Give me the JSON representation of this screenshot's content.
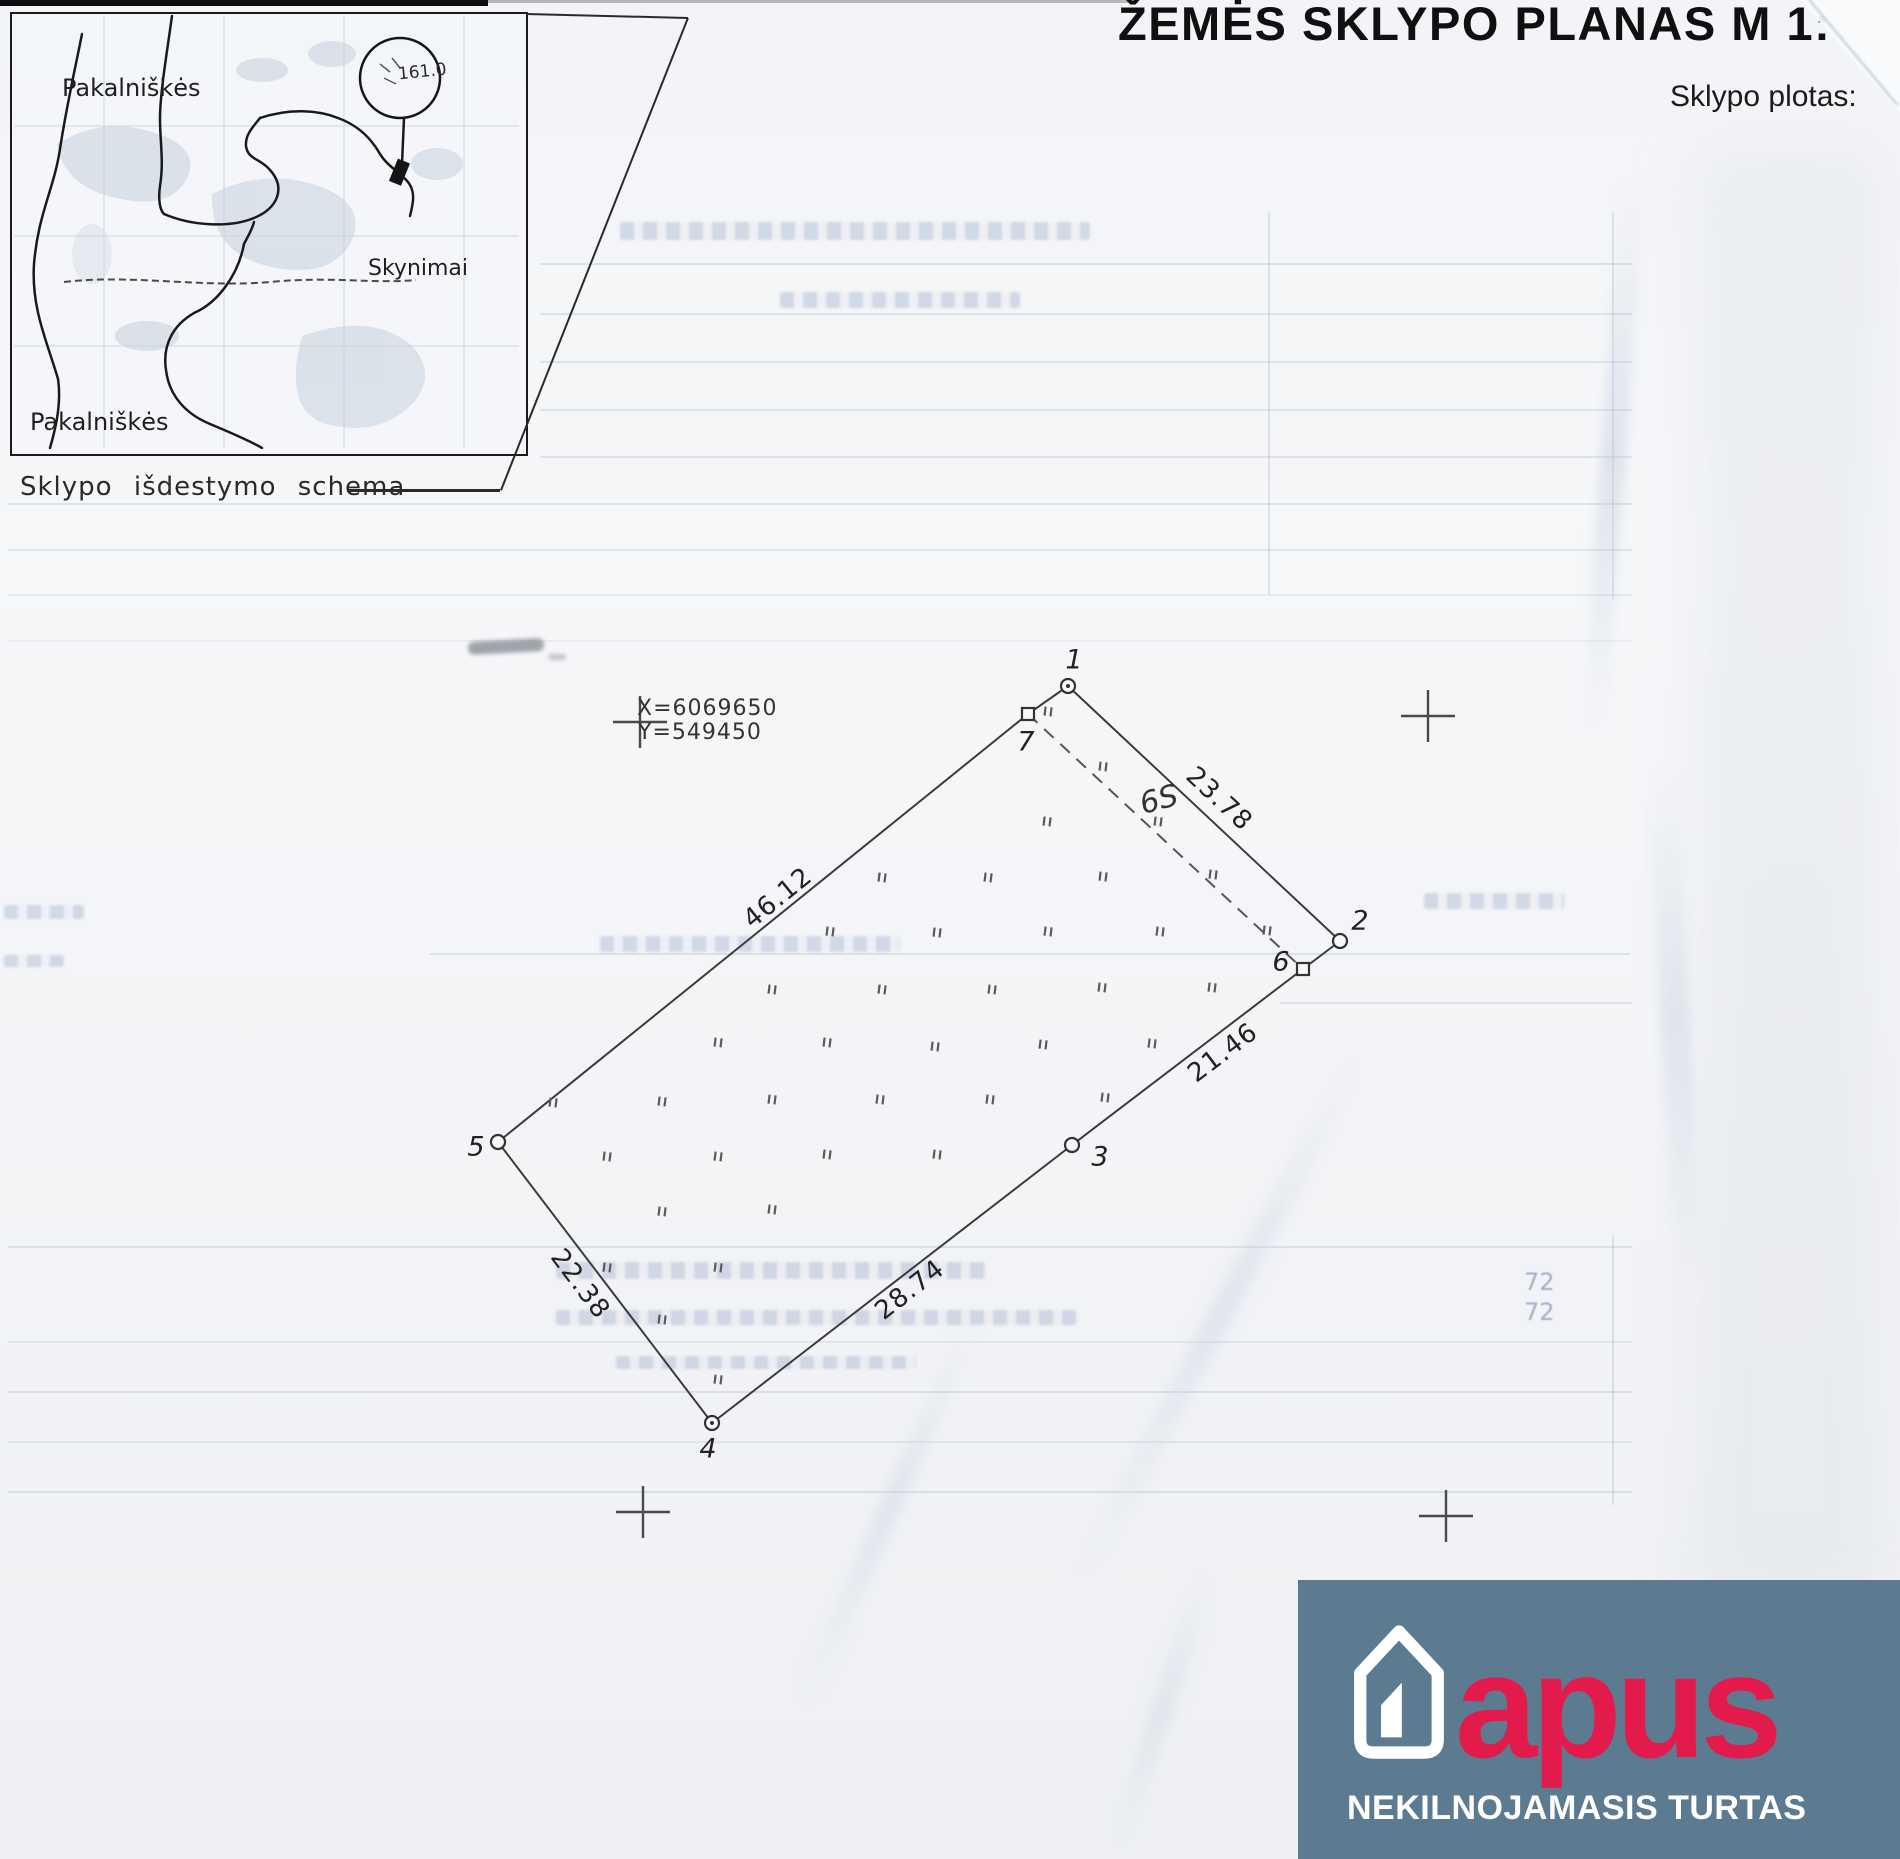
{
  "document": {
    "title": "ŽEMĖS SKLYPO PLANAS M 1:",
    "area_label": "Sklypo plotas:"
  },
  "inset_map": {
    "caption": "Sklypo išdestymo schema",
    "label_top": "Pakalniškės",
    "label_right": "Skynimai",
    "label_bottom": "Pakalniškės",
    "marker_value": "161.0"
  },
  "plan": {
    "coordinate_labels": {
      "x": "X=6069650",
      "y": "Y=549450"
    },
    "zone_label": "6S",
    "vertices": [
      {
        "id": "1",
        "x": 1068,
        "y": 686,
        "marker": "circle",
        "dot": true,
        "lx": 1074,
        "ly": 660
      },
      {
        "id": "2",
        "x": 1340,
        "y": 941,
        "marker": "circle",
        "dot": false,
        "lx": 1360,
        "ly": 921
      },
      {
        "id": "3",
        "x": 1072,
        "y": 1145,
        "marker": "circle",
        "dot": false,
        "lx": 1100,
        "ly": 1157
      },
      {
        "id": "4",
        "x": 712,
        "y": 1423,
        "marker": "circle",
        "dot": true,
        "lx": 708,
        "ly": 1449
      },
      {
        "id": "5",
        "x": 498,
        "y": 1142,
        "marker": "circle",
        "dot": false,
        "lx": 476,
        "ly": 1147
      },
      {
        "id": "6",
        "x": 1303,
        "y": 969,
        "marker": "square",
        "dot": false,
        "lx": 1281,
        "ly": 962
      },
      {
        "id": "7",
        "x": 1028,
        "y": 714,
        "marker": "square",
        "dot": false,
        "lx": 1026,
        "ly": 742
      }
    ],
    "edges": [
      [
        "1",
        "2"
      ],
      [
        "2",
        "6"
      ],
      [
        "6",
        "3"
      ],
      [
        "3",
        "4"
      ],
      [
        "4",
        "5"
      ],
      [
        "5",
        "7"
      ],
      [
        "7",
        "1"
      ]
    ],
    "dashed_edges": [
      [
        "7",
        "6"
      ]
    ],
    "edge_labels": [
      {
        "text": "23.78",
        "x": 1219,
        "y": 799,
        "rot": 43
      },
      {
        "text": "21.46",
        "x": 1223,
        "y": 1053,
        "rot": -37
      },
      {
        "text": "28.74",
        "x": 910,
        "y": 1290,
        "rot": -38
      },
      {
        "text": "22.38",
        "x": 580,
        "y": 1284,
        "rot": 53
      },
      {
        "text": "46.12",
        "x": 778,
        "y": 898,
        "rot": -39
      }
    ],
    "grid_crosses": [
      [
        640,
        722
      ],
      [
        1428,
        716
      ],
      [
        643,
        1512
      ],
      [
        1446,
        1516
      ]
    ],
    "tick_marks": [
      [
        1048,
        712
      ],
      [
        1103,
        767
      ],
      [
        1047,
        822
      ],
      [
        1158,
        822
      ],
      [
        1103,
        877
      ],
      [
        1213,
        875
      ],
      [
        1048,
        932
      ],
      [
        1160,
        932
      ],
      [
        1267,
        931
      ],
      [
        882,
        878
      ],
      [
        988,
        878
      ],
      [
        830,
        932
      ],
      [
        937,
        933
      ],
      [
        772,
        990
      ],
      [
        882,
        990
      ],
      [
        992,
        990
      ],
      [
        1102,
        988
      ],
      [
        1212,
        988
      ],
      [
        718,
        1043
      ],
      [
        827,
        1043
      ],
      [
        935,
        1047
      ],
      [
        1043,
        1045
      ],
      [
        1152,
        1044
      ],
      [
        553,
        1103
      ],
      [
        662,
        1102
      ],
      [
        772,
        1100
      ],
      [
        880,
        1100
      ],
      [
        990,
        1100
      ],
      [
        607,
        1157
      ],
      [
        718,
        1157
      ],
      [
        827,
        1155
      ],
      [
        937,
        1155
      ],
      [
        1105,
        1098
      ],
      [
        662,
        1212
      ],
      [
        772,
        1210
      ],
      [
        607,
        1268
      ],
      [
        718,
        1268
      ],
      [
        662,
        1320
      ],
      [
        718,
        1380
      ]
    ]
  },
  "logo": {
    "brand": "apus",
    "tagline": "NEKILNOJAMASIS TURTAS",
    "colors": {
      "background": "#5d7b90",
      "brand": "#e31b4c",
      "text": "#ffffff"
    }
  },
  "bleedthrough": {
    "faint_numbers": [
      "72",
      "72"
    ]
  }
}
